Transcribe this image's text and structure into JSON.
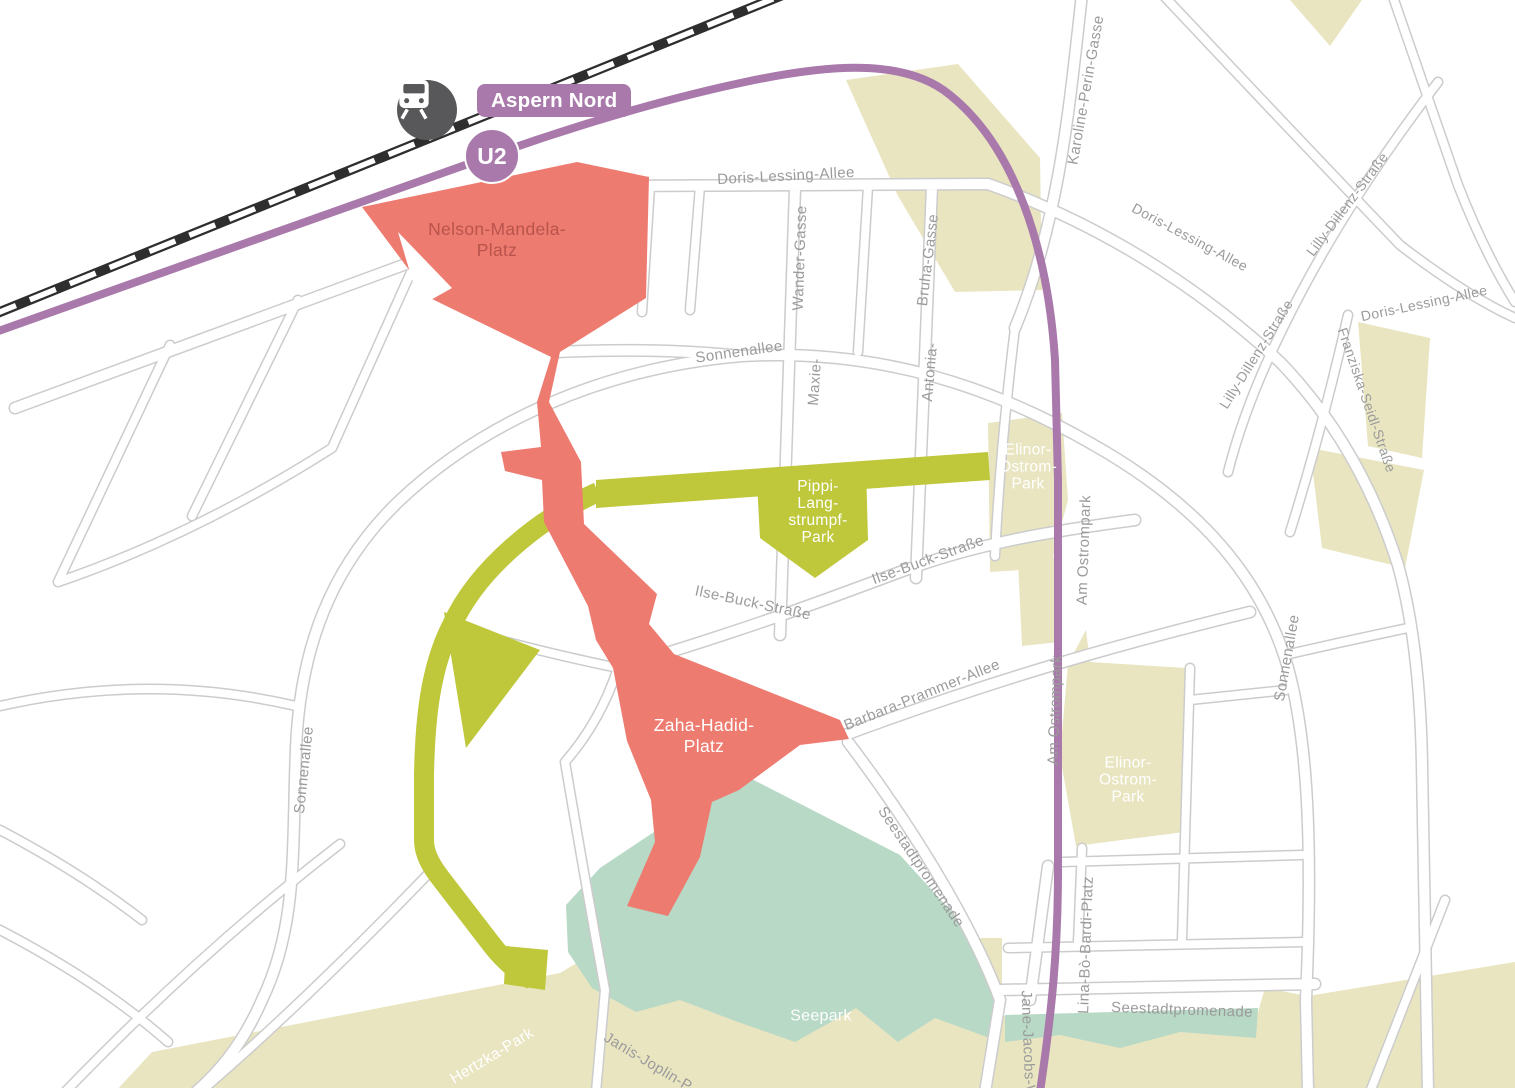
{
  "title": "Aspern Seestadt area map",
  "colors": {
    "red": "#ee7b70",
    "red_text": "#b8544c",
    "olive": "#bfc73a",
    "beige": "#e9e5c1",
    "teal": "#b7d9c6",
    "purple": "#a879aa",
    "rail": "#2e2e2e",
    "road_casing": "#cccccc",
    "street_text": "#9b9b9b",
    "station_gray": "#58585a",
    "white": "#ffffff"
  },
  "station": {
    "name": "Aspern Nord",
    "line": "U2"
  },
  "places": [
    {
      "id": "nelson-mandela-platz",
      "lines": [
        "Nelson-Mandela-",
        "Platz"
      ]
    },
    {
      "id": "zaha-hadid-platz",
      "lines": [
        "Zaha-Hadid-",
        "Platz"
      ]
    },
    {
      "id": "pippi-langstrumpf-park",
      "lines": [
        "Pippi-",
        "Lang-",
        "strumpf-",
        "Park"
      ]
    },
    {
      "id": "elinor-ostrom-park-upper",
      "lines": [
        "Elinor-",
        "Ostrom-",
        "Park"
      ]
    },
    {
      "id": "elinor-ostrom-park-lower",
      "lines": [
        "Elinor-",
        "Ostrom-",
        "Park"
      ]
    },
    {
      "id": "seepark",
      "lines": [
        "Seepark"
      ]
    },
    {
      "id": "hertzka-park",
      "lines": [
        "Hertzka-Park"
      ]
    }
  ],
  "streets": [
    {
      "name": "Doris-Lessing-Allee"
    },
    {
      "name": "Wander-Gasse"
    },
    {
      "name": "Bruha-Gasse"
    },
    {
      "name": "Sonnenallee"
    },
    {
      "name": "Maxie-"
    },
    {
      "name": "Antonia-"
    },
    {
      "name": "Karoline-Perin-Gasse"
    },
    {
      "name": "Doris-Lessing-Allee"
    },
    {
      "name": "Lilly-Dillenz-Straße"
    },
    {
      "name": "Lilly-Dillenz-Straße"
    },
    {
      "name": "Doris-Lessing-Allee"
    },
    {
      "name": "Franziska-Seidl-Straße"
    },
    {
      "name": "Ilse-Buck-Straße"
    },
    {
      "name": "Ilse-Buck-Straße"
    },
    {
      "name": "Am Ostrompark"
    },
    {
      "name": "Am Ostrompark"
    },
    {
      "name": "Sonnenallee"
    },
    {
      "name": "Sonnenallee"
    },
    {
      "name": "Barbara-Prammer-Allee"
    },
    {
      "name": "Seestadtpromenade"
    },
    {
      "name": "Seestadtpromenade"
    },
    {
      "name": "Lina-Bò-Bardi-Platz"
    },
    {
      "name": "Jane-Jacobs-W"
    },
    {
      "name": "Janis-Joplin-P"
    }
  ]
}
